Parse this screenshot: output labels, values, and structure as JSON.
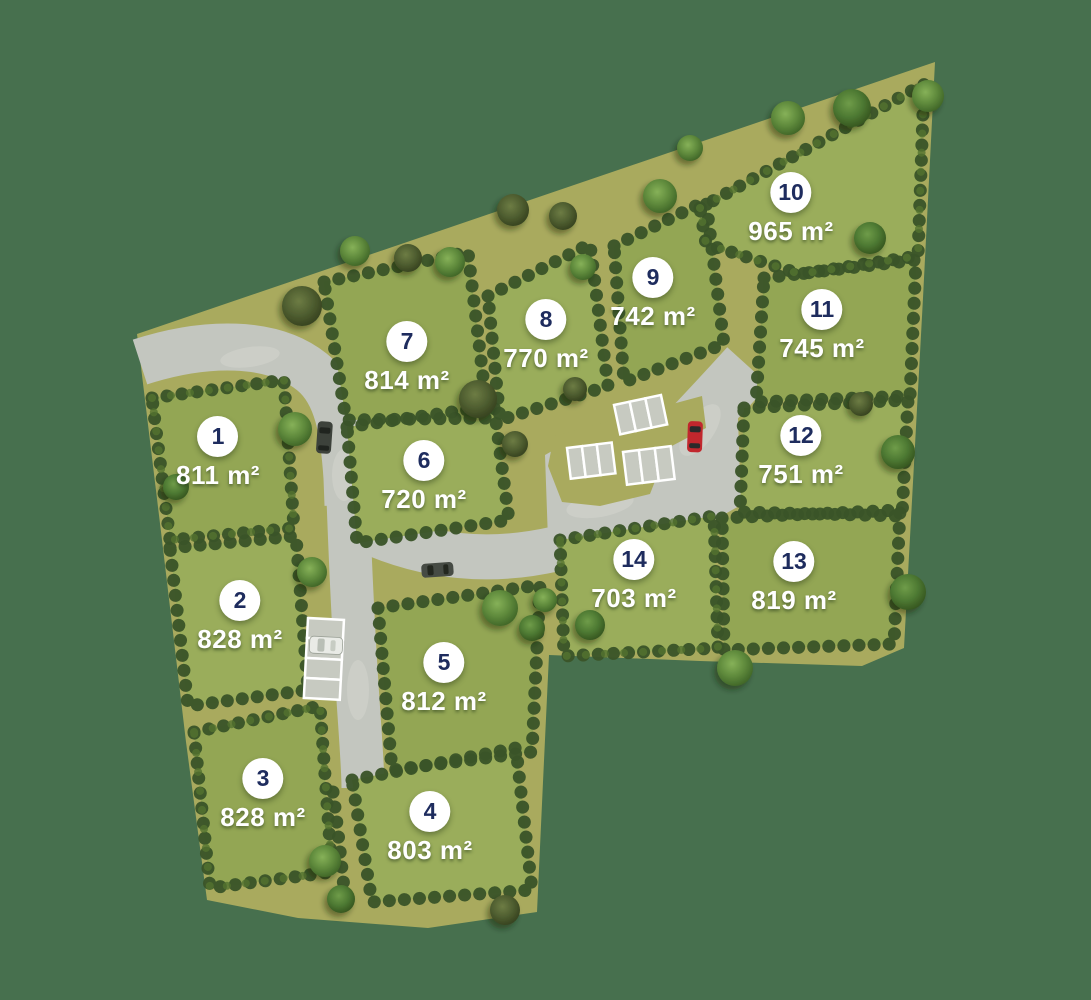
{
  "plots": [
    {
      "number": "1",
      "area": "811 m²"
    },
    {
      "number": "2",
      "area": "828 m²"
    },
    {
      "number": "3",
      "area": "828 m²"
    },
    {
      "number": "4",
      "area": "803 m²"
    },
    {
      "number": "5",
      "area": "812 m²"
    },
    {
      "number": "6",
      "area": "720 m²"
    },
    {
      "number": "7",
      "area": "814 m²"
    },
    {
      "number": "8",
      "area": "770 m²"
    },
    {
      "number": "9",
      "area": "742 m²"
    },
    {
      "number": "10",
      "area": "965 m²"
    },
    {
      "number": "11",
      "area": "745 m²"
    },
    {
      "number": "12",
      "area": "751 m²"
    },
    {
      "number": "13",
      "area": "819 m²"
    },
    {
      "number": "14",
      "area": "703 m²"
    }
  ],
  "colors": {
    "background": "#47704e",
    "site": "#a9aa5e",
    "grass": "#93a654",
    "hedge": "#3a5429",
    "road": "#c3c6bf",
    "parking_line": "#ffffff",
    "badge_bg": "#ffffff",
    "badge_text": "#1e2c5e",
    "label_text": "#ffffff",
    "car_red": "#c1272d",
    "car_dark": "#3d423b",
    "car_white": "#e9ebe6"
  }
}
